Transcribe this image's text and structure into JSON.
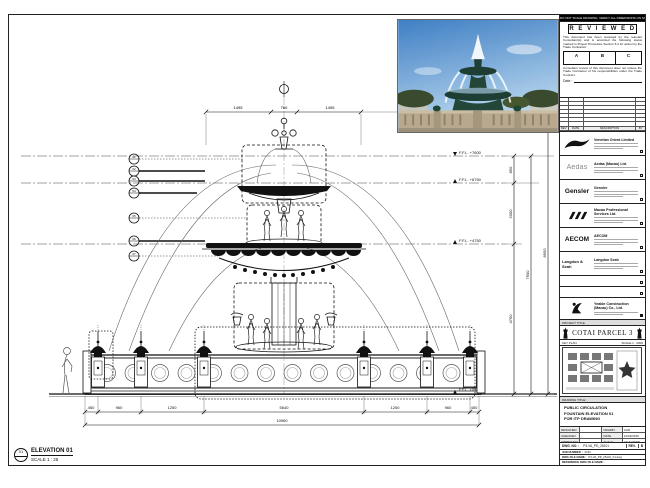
{
  "sheet": {
    "notice_bar": "DO NOT SCALE DRAWING. VERIFY ALL DIMENSIONS ON SITE.",
    "elevation_label": {
      "bubble_top": "01",
      "title": "ELEVATION 01",
      "scale": "SCALE 1 : 25"
    }
  },
  "stamp": {
    "title": "R E V I E W E D",
    "body": "This document has been reviewed by the relevant Consultant(s) and is accorded the following status marked in Project Procedure Section 5.4 for action by the Trade Contractor.",
    "grades": [
      "A",
      "B",
      "C"
    ],
    "note": "Consultant review of this document does not relieve the Trade Contractor of his responsibilities under the Trade Contract.",
    "date_label": "Date :"
  },
  "revisions": {
    "headers": [
      "REV",
      "DATE",
      "DESCRIPTION",
      "BY"
    ]
  },
  "consultants": [
    {
      "name": "Venetian Orient Limited",
      "logo": "venetian-flourish"
    },
    {
      "name": "Aedas (Macau) Ltd.",
      "logo": "Aedas"
    },
    {
      "name": "Gensler",
      "logo": "Gensler"
    },
    {
      "name": "Macau Professional Services Ltd.",
      "logo": "MPS"
    },
    {
      "name": "AECOM",
      "logo": "AECOM"
    },
    {
      "name": "Langdon Seah",
      "logo": "Langdon & Seah"
    }
  ],
  "contractor": {
    "name": "Yeable Construction (Macau) Co., Ltd."
  },
  "project": {
    "header": "PROJECT TITLE",
    "name": "COTAI PARCEL 3"
  },
  "key_plan": {
    "header": "KEY PLAN",
    "scale": "SCALE 1 : 2000"
  },
  "drawing_title": {
    "header": "DRAWING TITLE :",
    "line1": "PUBLIC CIRCULATION",
    "line2": "FOUNTAIN ELEVATION 01",
    "line3": "FOR ITP DRAWING"
  },
  "info": {
    "designed_label": "DESIGNED",
    "designed": "-",
    "drawn_label": "DRAWN",
    "drawn": "CAD",
    "checked_label": "CHECKED",
    "checked": "-",
    "date_label": "DATE",
    "date": "12/04/2015",
    "approved_label": "APPROVED",
    "approved": "-",
    "scale_label": "SCALE",
    "scale": "AS SHOWN",
    "dwg_no_label": "DWG. NO. :",
    "dwg_no": "P3-VA_PD_25101",
    "rev_label": "REV.",
    "rev": "B",
    "job_label": "JOB NUMBER :",
    "job": "2123",
    "file_label": "DWG FILE NAME :",
    "file": "P3-VA_PD_25101_F1.dwg",
    "ref_label": "REFERENCE DWG FILE NAME :",
    "ref": ""
  },
  "drawing": {
    "levels": [
      {
        "text": "F.F.L. +7600"
      },
      {
        "text": "F.F.L. +6750"
      },
      {
        "text": "F.F.L. +4750"
      },
      {
        "text": "F.F.L. ±0.00"
      }
    ],
    "vdims": [
      "850",
      "2000",
      "4750",
      "7600",
      "8950"
    ],
    "top_dims": [
      "1495",
      "760",
      "1495"
    ],
    "bottom_dims": [
      "450",
      "960",
      "1250",
      "5640",
      "1250",
      "960",
      "450"
    ],
    "bottom_total": "10960",
    "callouts": [
      "01",
      "02",
      "03",
      "04",
      "05",
      "06",
      "07"
    ]
  }
}
